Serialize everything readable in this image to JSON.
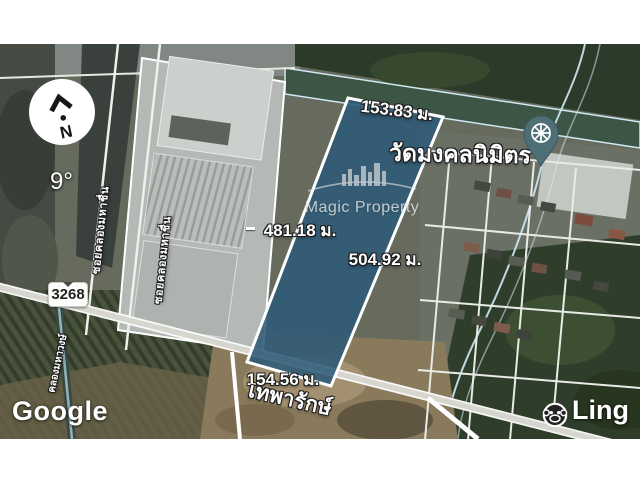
{
  "compass": {
    "letter": "N",
    "bearing": "9°"
  },
  "shield": {
    "route": "3268"
  },
  "poi": {
    "temple_name": "วัดมงคลนิมิตร"
  },
  "measurements": {
    "top": "153.83 ม.",
    "left": "481.18 ม.",
    "right": "504.92 ม.",
    "bottom": "154.56 ม."
  },
  "roads": {
    "main": "เทพารักษ์",
    "soi_upper": "ซอยคลองมหาชื่น",
    "soi_mid": "ซอยคลองมหาชื่น",
    "canal": "คลองมหาวงษ์"
  },
  "watermark": {
    "text": "Magic Property"
  },
  "branding": {
    "google": "Google",
    "ling": "Ling"
  },
  "colors": {
    "plot_fill": "#2d5a78",
    "plot_border": "#ffffff",
    "pin": "#4e6f75",
    "canal_outline": "#cfe9f4"
  }
}
